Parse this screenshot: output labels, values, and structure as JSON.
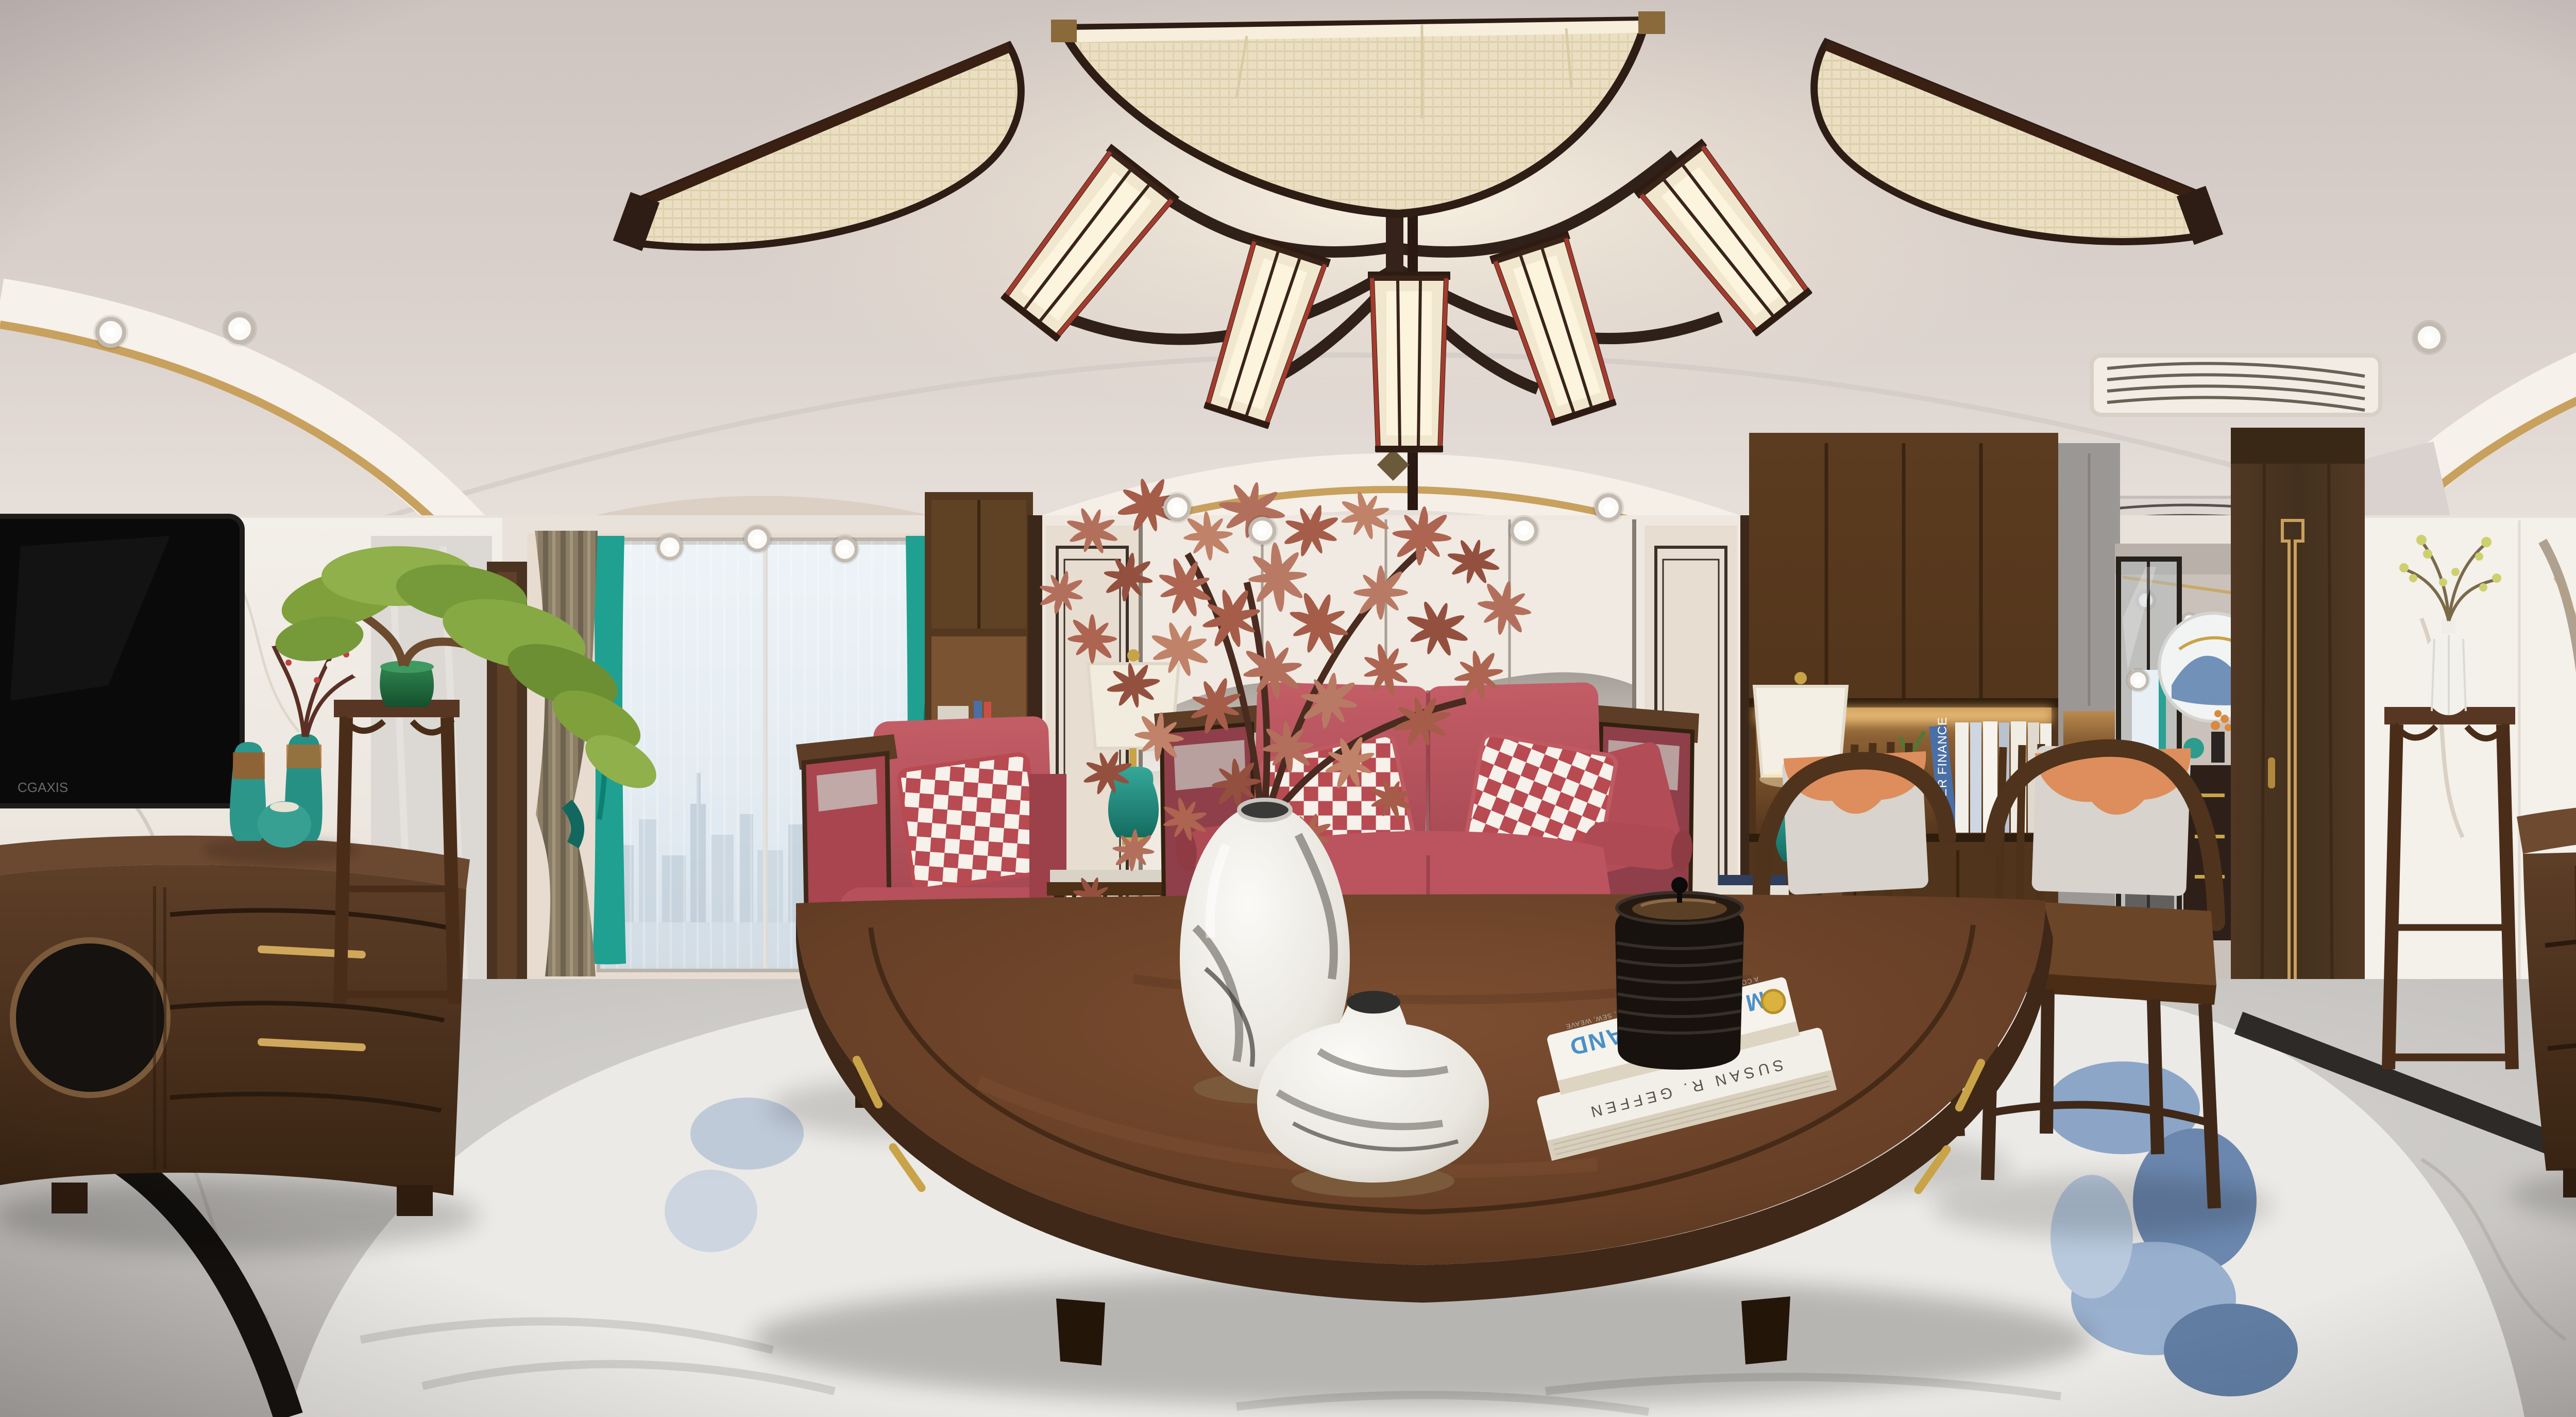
{
  "scene": {
    "description": "360-degree equirectangular panorama of a new-Chinese-style living room",
    "texts": {
      "tv_brand": "CGAXIS",
      "book_top_author": "LENA CORWIN'S",
      "book_top_title": "MADE BY HAND",
      "book_top_subtitle": "A COLLECTION OF PROJECTS TO PRINT, SEW, WEAVE",
      "book_bottom_spine": "SUSAN R. GEFFEN",
      "shelf_book_spine": "WATER FINANCE"
    },
    "colors": {
      "ceiling": "#d8cfca",
      "accent_gold": "#c8a15e",
      "wood_dark": "#46301d",
      "wood_console": "#5a3c28",
      "sofa_red": "#b6505a",
      "checker_red": "#b84a52",
      "curtain_teal": "#1fa091",
      "curtain_tan": "#8c7e65",
      "lamp_base_teal": "#2d9c8f",
      "orange_pillow": "#dd8e5c",
      "gray_cushion": "#d8d3cc",
      "marble_white": "#f2eee8",
      "floor_gray": "#c9c7c5",
      "rug_white": "#eceae6",
      "rug_blue": "#5b82b4",
      "bonsai_green": "#7fa03b",
      "book_title_blue": "#4a90c8",
      "mural_ink": "#6e6862"
    }
  }
}
